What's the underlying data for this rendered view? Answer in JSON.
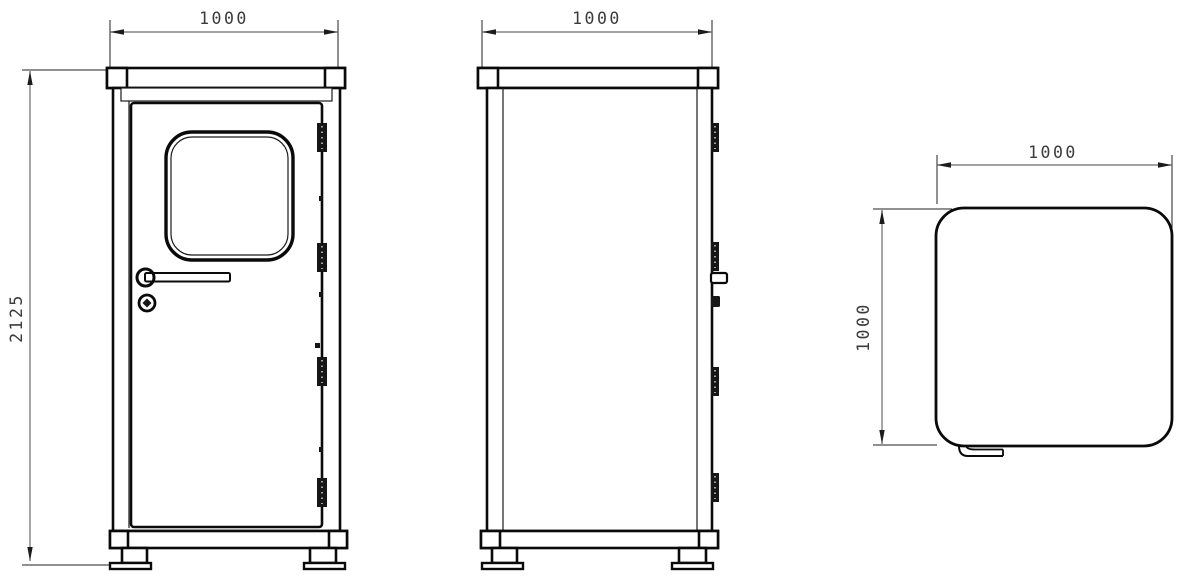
{
  "drawing": {
    "type": "technical-drawing",
    "views": {
      "front": {
        "width_label": "1000",
        "height_label": "2125"
      },
      "side": {
        "width_label": "1000"
      },
      "top": {
        "width_label": "1000",
        "depth_label": "1000"
      }
    },
    "colors": {
      "outline": "#0a0a0a",
      "dimension_line": "#6b6b6b",
      "dimension_text": "#3b3b3b",
      "background": "#ffffff"
    }
  }
}
